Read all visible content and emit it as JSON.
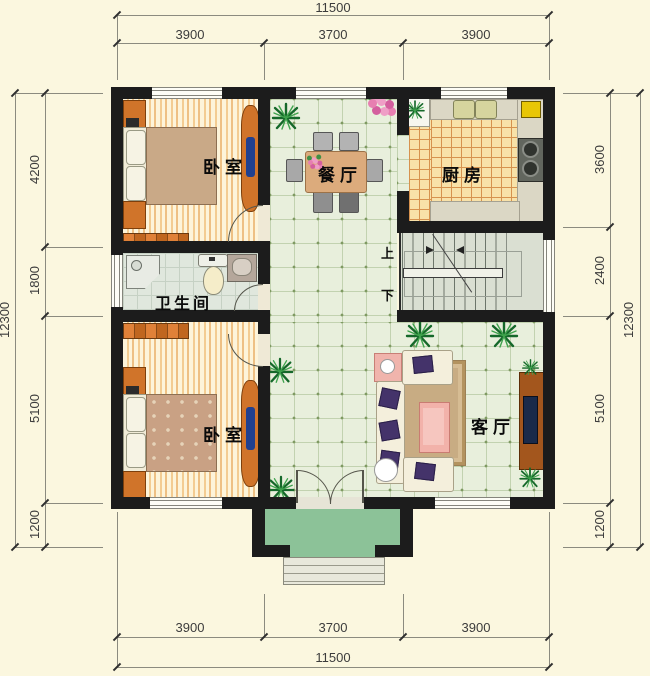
{
  "plan": {
    "rooms": {
      "bedroom_top": "卧室",
      "dining": "餐厅",
      "kitchen": "厨房",
      "bathroom": "卫生间",
      "bedroom_bottom": "卧室",
      "living": "客厅"
    },
    "stairs": {
      "up": "上",
      "down": "下"
    }
  },
  "dimensions": {
    "top": {
      "overall": "11500",
      "segments": [
        "3900",
        "3700",
        "3900"
      ]
    },
    "bottom": {
      "overall": "11500",
      "segments": [
        "3900",
        "3700",
        "3900"
      ]
    },
    "left": {
      "overall": "12300",
      "segments": [
        "4200",
        "1800",
        "5100",
        "1200"
      ]
    },
    "right": {
      "overall": "12300",
      "segments": [
        "3600",
        "2400",
        "5100",
        "1200"
      ]
    }
  },
  "colors": {
    "wall": "#1c1c1c",
    "paper": "#fbf7df",
    "hall_floor": "#e8efdc",
    "kitchen_tile": "#f8e1a8",
    "bedroom_stripe": "#f3cc92",
    "bathroom_floor": "#e0e7dd",
    "stair_floor": "#dadfd2",
    "porch_green": "#8cc298",
    "wood": "#d0742a",
    "wardrobe_navy": "#20408f",
    "sofa_cream": "#f4efdc",
    "pillow_purple": "#44336a",
    "rug": "#c8ac83",
    "coffee_table_pink": "#f2b2aa",
    "tv_cabinet": "#a3561d",
    "dim_text": "#3c3c3c"
  }
}
